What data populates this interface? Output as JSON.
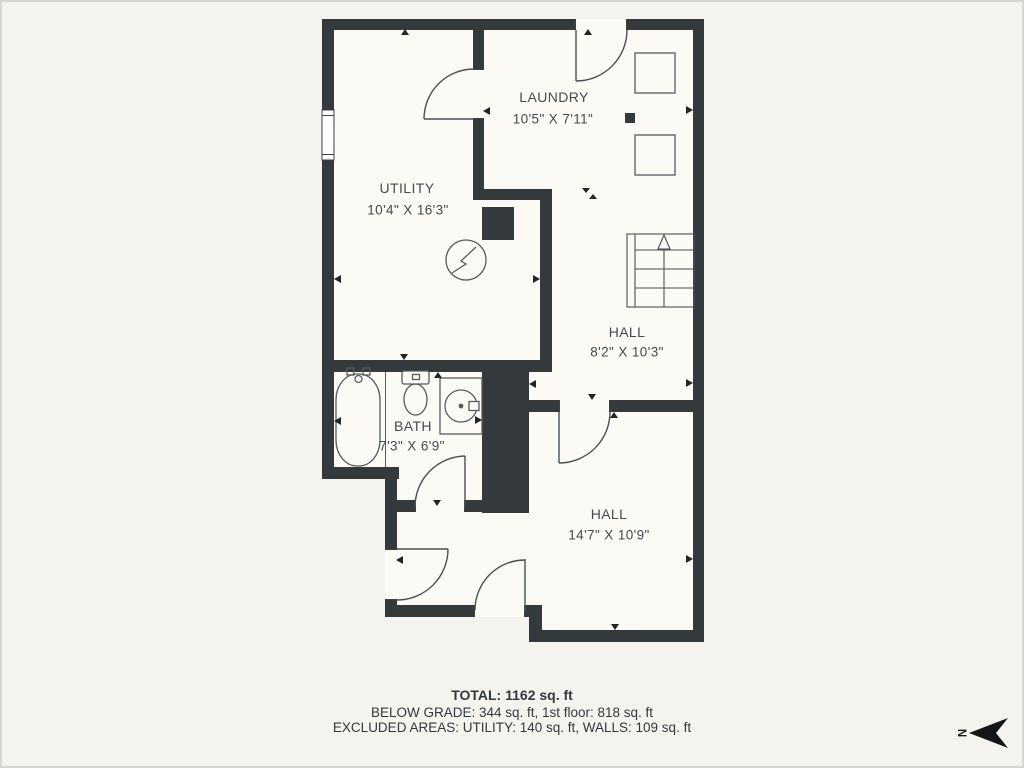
{
  "rooms": [
    {
      "id": "laundry",
      "name": "LAUNDRY",
      "dims": "10'5\" X 7'11\""
    },
    {
      "id": "utility",
      "name": "UTILITY",
      "dims": "10'4\" X 16'3\""
    },
    {
      "id": "hall_upper",
      "name": "HALL",
      "dims": "8'2\" X 10'3\""
    },
    {
      "id": "bath",
      "name": "BATH",
      "dims": "7'3\" X 6'9\""
    },
    {
      "id": "hall_lower",
      "name": "HALL",
      "dims": "14'7\" X 10'9\""
    }
  ],
  "summary": {
    "total": "TOTAL: 1162 sq. ft",
    "below_grade": "BELOW GRADE: 344 sq. ft, 1st floor: 818 sq. ft",
    "excluded": "EXCLUDED AREAS: UTILITY: 140 sq. ft, WALLS: 109 sq. ft"
  },
  "compass": {
    "north_label": "N"
  },
  "colors": {
    "wall": "#34393c",
    "floor": "#fbfaf5",
    "background": "#f4f3ee",
    "label_text": "#454a4e",
    "summary_text": "#33383b"
  },
  "icons": {
    "stairs": "stairs-up-icon",
    "washer_dryer": "appliance-square-icons",
    "electrical": "electric-panel-icon",
    "bath_fixtures": [
      "bathtub-icon",
      "toilet-icon",
      "sink-icon"
    ],
    "window": "window-icon",
    "doors": "door-swing-icon",
    "north": "north-arrow-icon"
  }
}
